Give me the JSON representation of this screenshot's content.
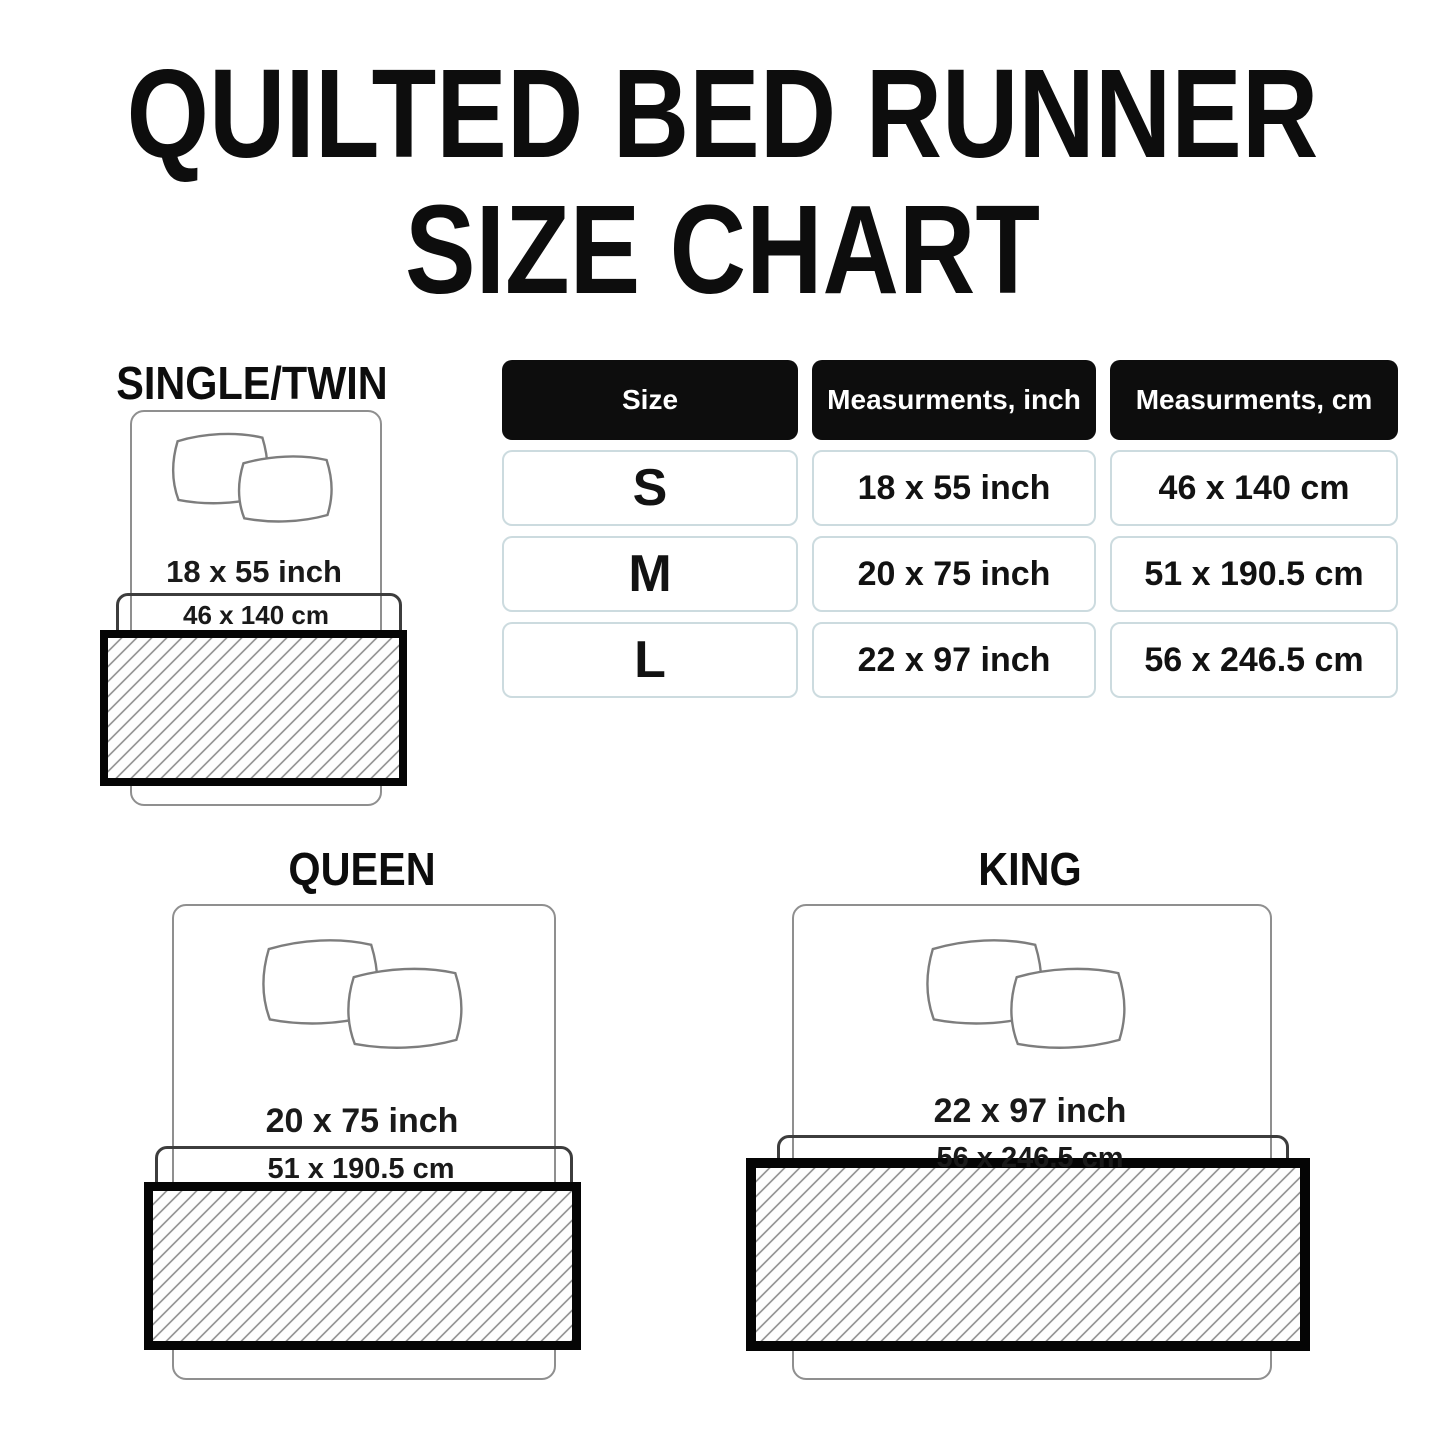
{
  "title": {
    "line1": "QUILTED BED RUNNER",
    "line2": "SIZE CHART"
  },
  "table": {
    "headers": [
      "Size",
      "Measurments, inch",
      "Measurments, cm"
    ],
    "rows": [
      {
        "size": "S",
        "inch": "18 x 55 inch",
        "cm": "46 x 140 cm"
      },
      {
        "size": "M",
        "inch": "20 x 75 inch",
        "cm": "51 x 190.5 cm"
      },
      {
        "size": "L",
        "inch": "22 x 97 inch",
        "cm": "56 x 246.5 cm"
      }
    ]
  },
  "diagrams": [
    {
      "label": "SINGLE/TWIN",
      "inch": "18 x 55 inch",
      "cm": "46 x 140 cm"
    },
    {
      "label": "QUEEN",
      "inch": "20 x 75 inch",
      "cm": "51 x 190.5 cm"
    },
    {
      "label": "KING",
      "inch": "22 x 97 inch",
      "cm": "56 x 246.5 cm"
    }
  ],
  "colors": {
    "header_bg": "#0d0d0d",
    "cell_border": "#ccdbdf",
    "hatch_line": "#9a9a9a",
    "runner_border": "#050505",
    "bed_outline": "#8f8f8f"
  }
}
